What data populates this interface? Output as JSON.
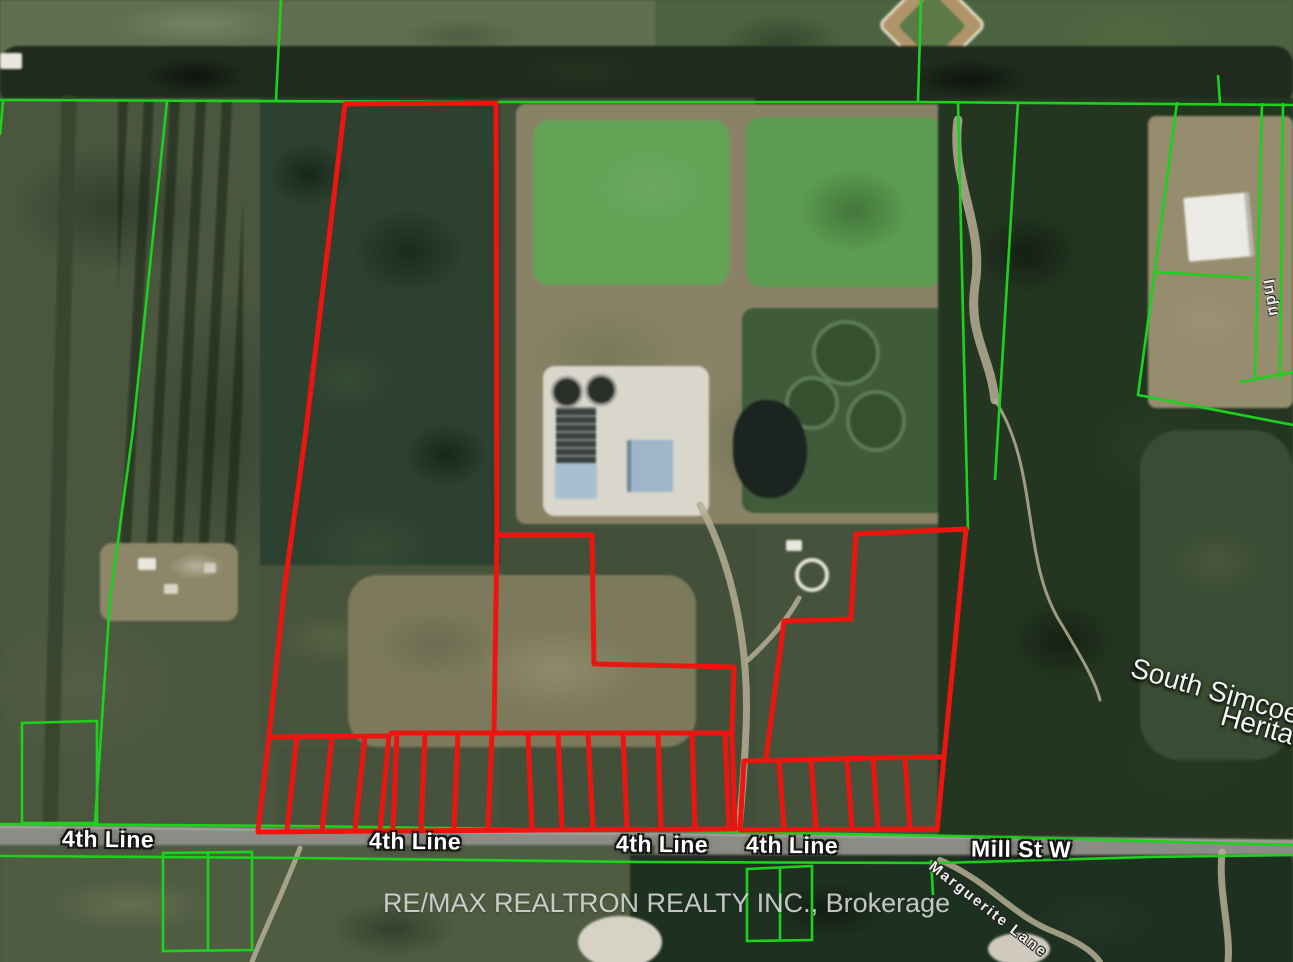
{
  "map": {
    "description": "Aerial satellite real-estate map with red subject-property boundary and green neighbouring parcel boundaries",
    "watermark": "RE/MAX REALTRON REALTY INC., Brokerage",
    "road_labels": {
      "fourth_line_1": "4th Line",
      "fourth_line_2": "4th Line",
      "fourth_line_3": "4th Line",
      "fourth_line_4": "4th Line",
      "mill_st_w": "Mill St W",
      "marguerite_lane": "Marguerite Lane",
      "edge_road_partial": "Indu"
    },
    "area_labels": {
      "south_simcoe_line1": "South Simcoe",
      "south_simcoe_line2": "Herita"
    },
    "colors": {
      "boundary_red": "#ee1510",
      "boundary_green": "#1dd21d",
      "road_gray": "#8c8c86",
      "lagoon_green": "#63a356",
      "forest_dark": "#24361f",
      "field_olive": "#4a563e",
      "dirt_tan": "#8a8266"
    },
    "features": {
      "red_parcels_count": 2,
      "red_lot_strips_main_parcel": 15,
      "red_lot_strips_east_parcel": 6
    }
  }
}
